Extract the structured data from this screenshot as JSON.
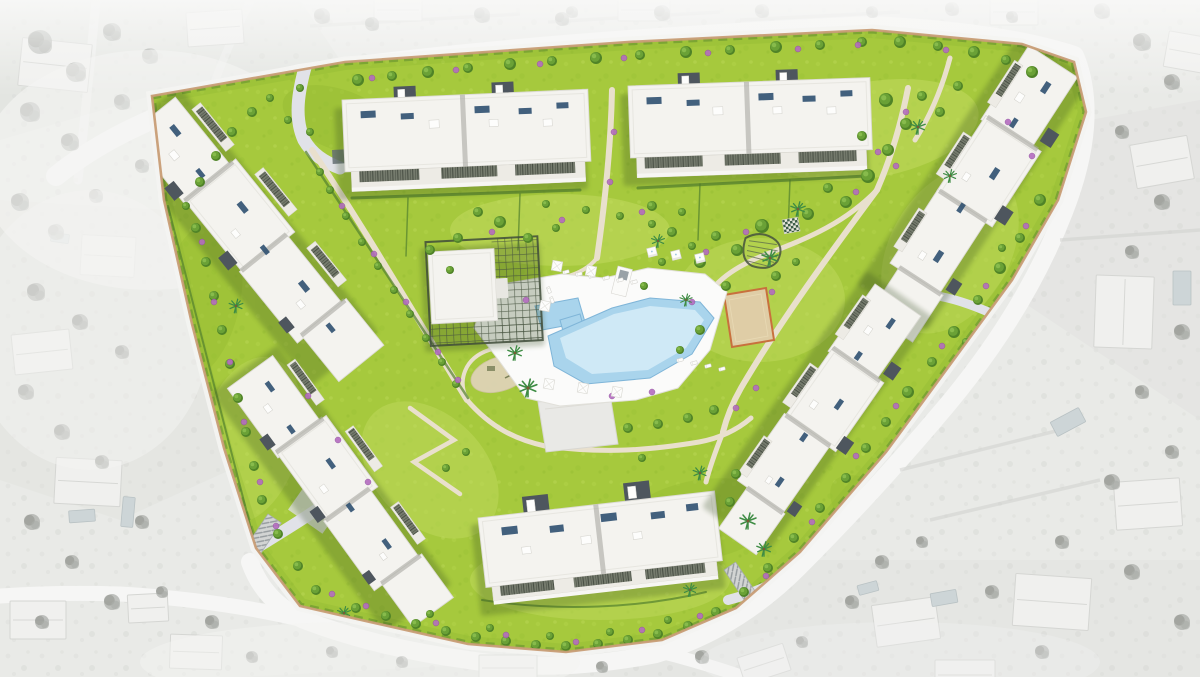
{
  "meta": {
    "type": "architectural-masterplan-render",
    "view": "top-down-aerial",
    "style": "colored-development-over-grayscale-context"
  },
  "colors": {
    "surr_base": "#e9eae7",
    "surr_shade": "#dfe0dd",
    "surr_road": "#f6f6f5",
    "surr_house": "#f0f0ee",
    "surr_roof": "#d5d6d3",
    "surr_tree": "#abada9",
    "surr_tree_dark": "#8f918d",
    "surr_pool": "#cdd5d7",
    "grass": "#a6c93d",
    "grass_light": "#c3dc62",
    "grass_dark": "#96bc33",
    "hedge": "#53802d",
    "tree": "#6aa136",
    "tree_dark": "#4f8327",
    "bush": "#b46cc0",
    "palm": "#3e8c44",
    "path": "#e9e0cd",
    "road": "#e1e2e8",
    "wall": "#c89d76",
    "deck": "#fbfbfa",
    "water": "#a9d4ec",
    "water_light": "#d6ecf8",
    "water_edge": "#7fb5d8",
    "roof": "#f4f3ef",
    "roof_line": "#dcdbd5",
    "facade": "#a9a8a1",
    "core": "#4e565e",
    "panel": "#2f5070",
    "pergola": "#6b7163",
    "sand": "#dfcda6",
    "sand_edge": "#c8703d",
    "platform": "#e9e9e6",
    "ramp": "#d2d4d3",
    "shadow": "#31491b"
  },
  "scene": {
    "development": {
      "buildings": [
        {
          "id": "block-top-left",
          "type": "apartment-block"
        },
        {
          "id": "block-top-right",
          "type": "apartment-block"
        },
        {
          "id": "block-north-east",
          "type": "apartment-block"
        },
        {
          "id": "block-east",
          "type": "apartment-block"
        },
        {
          "id": "block-west",
          "type": "apartment-block"
        },
        {
          "id": "block-south-west",
          "type": "apartment-block"
        },
        {
          "id": "block-south",
          "type": "apartment-block"
        },
        {
          "id": "clubhouse",
          "type": "clubhouse-with-pergola"
        }
      ],
      "amenities": [
        "swimming-pool",
        "kids-pool",
        "pool-deck",
        "sun-loungers",
        "cabanas",
        "parasols",
        "gazebo",
        "giant-chess",
        "petanque-court",
        "playground",
        "event-platform",
        "garden-paths",
        "garage-ramps"
      ],
      "landscape": [
        "lawns",
        "palm-trees",
        "flowering-shrubs",
        "hedges",
        "perimeter-wall"
      ]
    },
    "surroundings": [
      "grayscale-aerial-neighbourhood",
      "villas-with-pools",
      "perimeter-roads",
      "tree-clusters"
    ],
    "trees": [
      [
        358,
        80,
        6
      ],
      [
        392,
        76,
        5
      ],
      [
        428,
        72,
        6
      ],
      [
        468,
        68,
        5
      ],
      [
        510,
        64,
        6
      ],
      [
        552,
        61,
        5
      ],
      [
        596,
        58,
        6
      ],
      [
        640,
        55,
        5
      ],
      [
        686,
        52,
        6
      ],
      [
        730,
        50,
        5
      ],
      [
        776,
        47,
        6
      ],
      [
        820,
        45,
        5
      ],
      [
        862,
        42,
        5
      ],
      [
        900,
        42,
        6
      ],
      [
        938,
        46,
        5
      ],
      [
        974,
        52,
        6
      ],
      [
        1006,
        60,
        5
      ],
      [
        1032,
        72,
        6
      ],
      [
        886,
        100,
        7
      ],
      [
        906,
        124,
        6
      ],
      [
        888,
        150,
        6
      ],
      [
        868,
        176,
        7
      ],
      [
        846,
        202,
        6
      ],
      [
        922,
        96,
        5
      ],
      [
        940,
        112,
        5
      ],
      [
        862,
        136,
        5
      ],
      [
        828,
        188,
        5
      ],
      [
        808,
        214,
        6
      ],
      [
        958,
        86,
        5
      ],
      [
        762,
        226,
        7
      ],
      [
        737,
        250,
        6
      ],
      [
        716,
        236,
        5
      ],
      [
        700,
        262,
        6
      ],
      [
        726,
        286,
        5
      ],
      [
        692,
        246,
        4
      ],
      [
        776,
        276,
        5
      ],
      [
        796,
        262,
        4
      ],
      [
        672,
        232,
        5
      ],
      [
        652,
        224,
        4
      ],
      [
        662,
        262,
        4
      ],
      [
        644,
        286,
        4
      ],
      [
        700,
        330,
        5
      ],
      [
        680,
        350,
        4
      ],
      [
        1040,
        200,
        6
      ],
      [
        1020,
        238,
        5
      ],
      [
        1000,
        268,
        6
      ],
      [
        978,
        300,
        5
      ],
      [
        954,
        332,
        6
      ],
      [
        932,
        362,
        5
      ],
      [
        908,
        392,
        6
      ],
      [
        886,
        422,
        5
      ],
      [
        952,
        396,
        4
      ],
      [
        1002,
        248,
        4
      ],
      [
        966,
        342,
        4
      ],
      [
        866,
        448,
        5
      ],
      [
        846,
        478,
        5
      ],
      [
        820,
        508,
        5
      ],
      [
        794,
        538,
        5
      ],
      [
        768,
        568,
        5
      ],
      [
        744,
        592,
        5
      ],
      [
        716,
        612,
        5
      ],
      [
        918,
        428,
        4
      ],
      [
        896,
        458,
        4
      ],
      [
        872,
        488,
        4
      ],
      [
        688,
        626,
        5
      ],
      [
        658,
        634,
        5
      ],
      [
        628,
        640,
        5
      ],
      [
        598,
        644,
        5
      ],
      [
        566,
        646,
        5
      ],
      [
        536,
        645,
        5
      ],
      [
        506,
        641,
        5
      ],
      [
        476,
        637,
        5
      ],
      [
        446,
        631,
        5
      ],
      [
        416,
        624,
        5
      ],
      [
        386,
        616,
        5
      ],
      [
        356,
        608,
        5
      ],
      [
        430,
        614,
        4
      ],
      [
        490,
        628,
        4
      ],
      [
        550,
        636,
        4
      ],
      [
        610,
        632,
        4
      ],
      [
        668,
        620,
        4
      ],
      [
        196,
        228,
        5
      ],
      [
        206,
        262,
        5
      ],
      [
        214,
        296,
        5
      ],
      [
        222,
        330,
        5
      ],
      [
        230,
        364,
        5
      ],
      [
        238,
        398,
        5
      ],
      [
        246,
        432,
        5
      ],
      [
        254,
        466,
        5
      ],
      [
        262,
        500,
        5
      ],
      [
        278,
        534,
        5
      ],
      [
        298,
        566,
        5
      ],
      [
        316,
        590,
        5
      ],
      [
        330,
        190,
        4
      ],
      [
        346,
        216,
        4
      ],
      [
        362,
        242,
        4
      ],
      [
        378,
        266,
        4
      ],
      [
        394,
        290,
        4
      ],
      [
        410,
        314,
        4
      ],
      [
        426,
        338,
        4
      ],
      [
        442,
        362,
        4
      ],
      [
        456,
        384,
        4
      ],
      [
        320,
        172,
        4
      ],
      [
        500,
        222,
        6
      ],
      [
        528,
        238,
        5
      ],
      [
        556,
        228,
        4
      ],
      [
        478,
        212,
        5
      ],
      [
        458,
        238,
        5
      ],
      [
        652,
        206,
        5
      ],
      [
        682,
        212,
        4
      ],
      [
        620,
        216,
        4
      ],
      [
        586,
        210,
        4
      ],
      [
        546,
        204,
        4
      ],
      [
        430,
        250,
        5
      ],
      [
        450,
        270,
        4
      ],
      [
        628,
        428,
        5
      ],
      [
        658,
        424,
        5
      ],
      [
        688,
        418,
        5
      ],
      [
        714,
        410,
        5
      ],
      [
        642,
        458,
        4
      ],
      [
        736,
        474,
        5
      ],
      [
        730,
        502,
        5
      ],
      [
        466,
        452,
        4
      ],
      [
        446,
        468,
        4
      ],
      [
        252,
        112,
        5
      ],
      [
        232,
        132,
        5
      ],
      [
        216,
        156,
        5
      ],
      [
        270,
        98,
        4
      ],
      [
        300,
        88,
        4
      ],
      [
        200,
        182,
        5
      ],
      [
        186,
        206,
        4
      ],
      [
        288,
        120,
        4
      ],
      [
        310,
        132,
        4
      ]
    ],
    "bushes": [
      [
        372,
        78,
        3
      ],
      [
        456,
        70,
        3
      ],
      [
        540,
        64,
        3
      ],
      [
        624,
        58,
        3
      ],
      [
        708,
        53,
        3
      ],
      [
        798,
        49,
        3
      ],
      [
        858,
        45,
        3
      ],
      [
        946,
        50,
        3
      ],
      [
        1008,
        122,
        3
      ],
      [
        1032,
        156,
        3
      ],
      [
        896,
        166,
        3
      ],
      [
        856,
        192,
        3
      ],
      [
        746,
        232,
        3
      ],
      [
        706,
        252,
        3
      ],
      [
        772,
        292,
        3
      ],
      [
        692,
        302,
        3
      ],
      [
        1026,
        226,
        3
      ],
      [
        986,
        286,
        3
      ],
      [
        942,
        346,
        3
      ],
      [
        896,
        406,
        3
      ],
      [
        856,
        456,
        3
      ],
      [
        812,
        522,
        3
      ],
      [
        766,
        576,
        3
      ],
      [
        700,
        616,
        3
      ],
      [
        642,
        630,
        3
      ],
      [
        576,
        642,
        3
      ],
      [
        506,
        635,
        3
      ],
      [
        436,
        623,
        3
      ],
      [
        366,
        606,
        3
      ],
      [
        332,
        594,
        3
      ],
      [
        202,
        242,
        3
      ],
      [
        214,
        302,
        3
      ],
      [
        230,
        362,
        3
      ],
      [
        244,
        422,
        3
      ],
      [
        260,
        482,
        3
      ],
      [
        276,
        526,
        3
      ],
      [
        342,
        206,
        3
      ],
      [
        374,
        254,
        3
      ],
      [
        406,
        302,
        3
      ],
      [
        438,
        352,
        3
      ],
      [
        458,
        380,
        3
      ],
      [
        492,
        232,
        3
      ],
      [
        562,
        220,
        3
      ],
      [
        642,
        212,
        3
      ],
      [
        526,
        300,
        3
      ],
      [
        612,
        396,
        3
      ],
      [
        652,
        392,
        3
      ],
      [
        308,
        396,
        3
      ],
      [
        338,
        440,
        3
      ],
      [
        368,
        482,
        3
      ],
      [
        614,
        132,
        3
      ],
      [
        610,
        182,
        3
      ],
      [
        906,
        112,
        3
      ],
      [
        878,
        152,
        3
      ],
      [
        736,
        408,
        3
      ],
      [
        756,
        388,
        3
      ]
    ],
    "palms": [
      [
        528,
        388,
        1.1
      ],
      [
        515,
        353,
        0.9
      ],
      [
        770,
        258,
        1
      ],
      [
        798,
        209,
        0.9
      ],
      [
        918,
        127,
        0.9
      ],
      [
        748,
        521,
        1
      ],
      [
        764,
        549,
        0.9
      ],
      [
        700,
        473,
        0.85
      ],
      [
        236,
        306,
        0.85
      ],
      [
        312,
        628,
        0.9
      ],
      [
        344,
        613,
        0.8
      ],
      [
        658,
        241,
        0.8
      ],
      [
        950,
        176,
        0.8
      ],
      [
        690,
        590,
        0.8
      ],
      [
        686,
        300,
        0.75
      ]
    ],
    "gray_trees": [
      [
        40,
        42,
        12
      ],
      [
        76,
        72,
        10
      ],
      [
        112,
        32,
        9
      ],
      [
        150,
        56,
        8
      ],
      [
        30,
        112,
        10
      ],
      [
        70,
        142,
        9
      ],
      [
        122,
        102,
        8
      ],
      [
        20,
        202,
        9
      ],
      [
        56,
        232,
        8
      ],
      [
        96,
        196,
        7
      ],
      [
        142,
        166,
        7
      ],
      [
        36,
        292,
        9
      ],
      [
        80,
        322,
        8
      ],
      [
        122,
        352,
        7
      ],
      [
        26,
        392,
        8
      ],
      [
        62,
        432,
        8
      ],
      [
        102,
        462,
        7
      ],
      [
        32,
        522,
        8
      ],
      [
        72,
        562,
        7
      ],
      [
        142,
        522,
        7
      ],
      [
        112,
        602,
        8
      ],
      [
        42,
        622,
        7
      ],
      [
        162,
        592,
        6
      ],
      [
        212,
        622,
        7
      ],
      [
        252,
        657,
        6
      ],
      [
        322,
        16,
        8
      ],
      [
        372,
        24,
        7
      ],
      [
        482,
        15,
        8
      ],
      [
        562,
        19,
        7
      ],
      [
        662,
        13,
        8
      ],
      [
        762,
        11,
        7
      ],
      [
        952,
        9,
        7
      ],
      [
        1012,
        17,
        6
      ],
      [
        1102,
        11,
        8
      ],
      [
        1142,
        42,
        9
      ],
      [
        1172,
        82,
        8
      ],
      [
        1122,
        132,
        7
      ],
      [
        1162,
        202,
        8
      ],
      [
        1132,
        252,
        7
      ],
      [
        1182,
        332,
        8
      ],
      [
        1142,
        392,
        7
      ],
      [
        1172,
        452,
        7
      ],
      [
        1112,
        482,
        8
      ],
      [
        1062,
        542,
        7
      ],
      [
        1132,
        572,
        8
      ],
      [
        992,
        592,
        7
      ],
      [
        1182,
        622,
        8
      ],
      [
        1042,
        652,
        7
      ],
      [
        882,
        562,
        7
      ],
      [
        922,
        542,
        6
      ],
      [
        852,
        602,
        7
      ],
      [
        802,
        642,
        6
      ],
      [
        702,
        657,
        7
      ],
      [
        602,
        667,
        6
      ],
      [
        402,
        662,
        6
      ],
      [
        332,
        652,
        6
      ],
      [
        572,
        12,
        6
      ],
      [
        872,
        12,
        6
      ]
    ],
    "gray_houses": [
      [
        55,
        65,
        70,
        48,
        6
      ],
      [
        215,
        28,
        56,
        34,
        -4
      ],
      [
        108,
        256,
        54,
        40,
        3
      ],
      [
        42,
        352,
        58,
        40,
        -6
      ],
      [
        88,
        482,
        66,
        46,
        3
      ],
      [
        38,
        620,
        56,
        38,
        0
      ],
      [
        196,
        652,
        52,
        34,
        2
      ],
      [
        508,
        668,
        58,
        26,
        0
      ],
      [
        764,
        664,
        48,
        28,
        -18
      ],
      [
        906,
        622,
        64,
        42,
        -8
      ],
      [
        1052,
        602,
        76,
        52,
        4
      ],
      [
        1148,
        504,
        66,
        48,
        -4
      ],
      [
        1124,
        312,
        58,
        72,
        2
      ],
      [
        1162,
        162,
        58,
        44,
        -10
      ],
      [
        1014,
        12,
        48,
        26,
        0
      ],
      [
        644,
        10,
        52,
        22,
        0
      ],
      [
        398,
        10,
        48,
        22,
        0
      ],
      [
        1186,
        52,
        40,
        36,
        10
      ],
      [
        148,
        608,
        40,
        28,
        -3
      ],
      [
        965,
        675,
        60,
        30,
        0
      ]
    ],
    "gray_pools": [
      [
        82,
        516,
        26,
        12,
        -4
      ],
      [
        128,
        512,
        12,
        30,
        5
      ],
      [
        1068,
        422,
        32,
        16,
        -28
      ],
      [
        944,
        598,
        26,
        13,
        -10
      ],
      [
        1182,
        288,
        18,
        34,
        0
      ],
      [
        868,
        588,
        20,
        10,
        -15
      ],
      [
        60,
        238,
        18,
        9,
        8
      ]
    ],
    "loungers": [
      [
        566,
        272,
        -15
      ],
      [
        579,
        274,
        -15
      ],
      [
        592,
        276,
        -15
      ],
      [
        606,
        278,
        -15
      ],
      [
        620,
        280,
        -15
      ],
      [
        634,
        282,
        -15
      ],
      [
        680,
        360,
        -15
      ],
      [
        694,
        363,
        -15
      ],
      [
        708,
        366,
        -15
      ],
      [
        722,
        369,
        -15
      ],
      [
        549,
        290,
        70
      ],
      [
        552,
        300,
        70
      ]
    ],
    "cabanas": [
      [
        652,
        252
      ],
      [
        676,
        255
      ],
      [
        700,
        258
      ]
    ],
    "parasols": [
      [
        557,
        266
      ],
      [
        591,
        271
      ],
      [
        545,
        306
      ],
      [
        549,
        384
      ],
      [
        583,
        388
      ],
      [
        617,
        392
      ]
    ]
  }
}
